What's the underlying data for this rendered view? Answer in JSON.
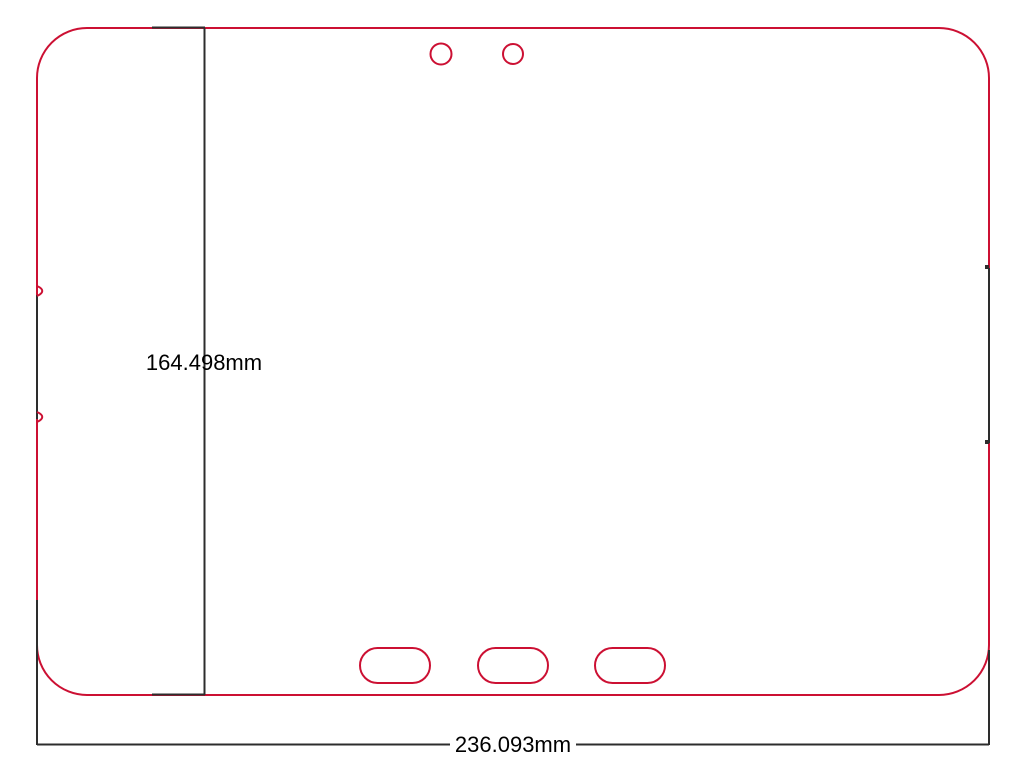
{
  "page": {
    "background_color": "#FFFFFF"
  },
  "drawing": {
    "outline_color": "#CC1033",
    "dimension_color": "#2D2D2D",
    "label_color": "#000000",
    "height_dimension": {
      "label": "164.498mm"
    },
    "width_dimension": {
      "label": "236.093mm"
    },
    "features": {
      "camera_holes": 2,
      "bottom_slots": 3
    }
  }
}
